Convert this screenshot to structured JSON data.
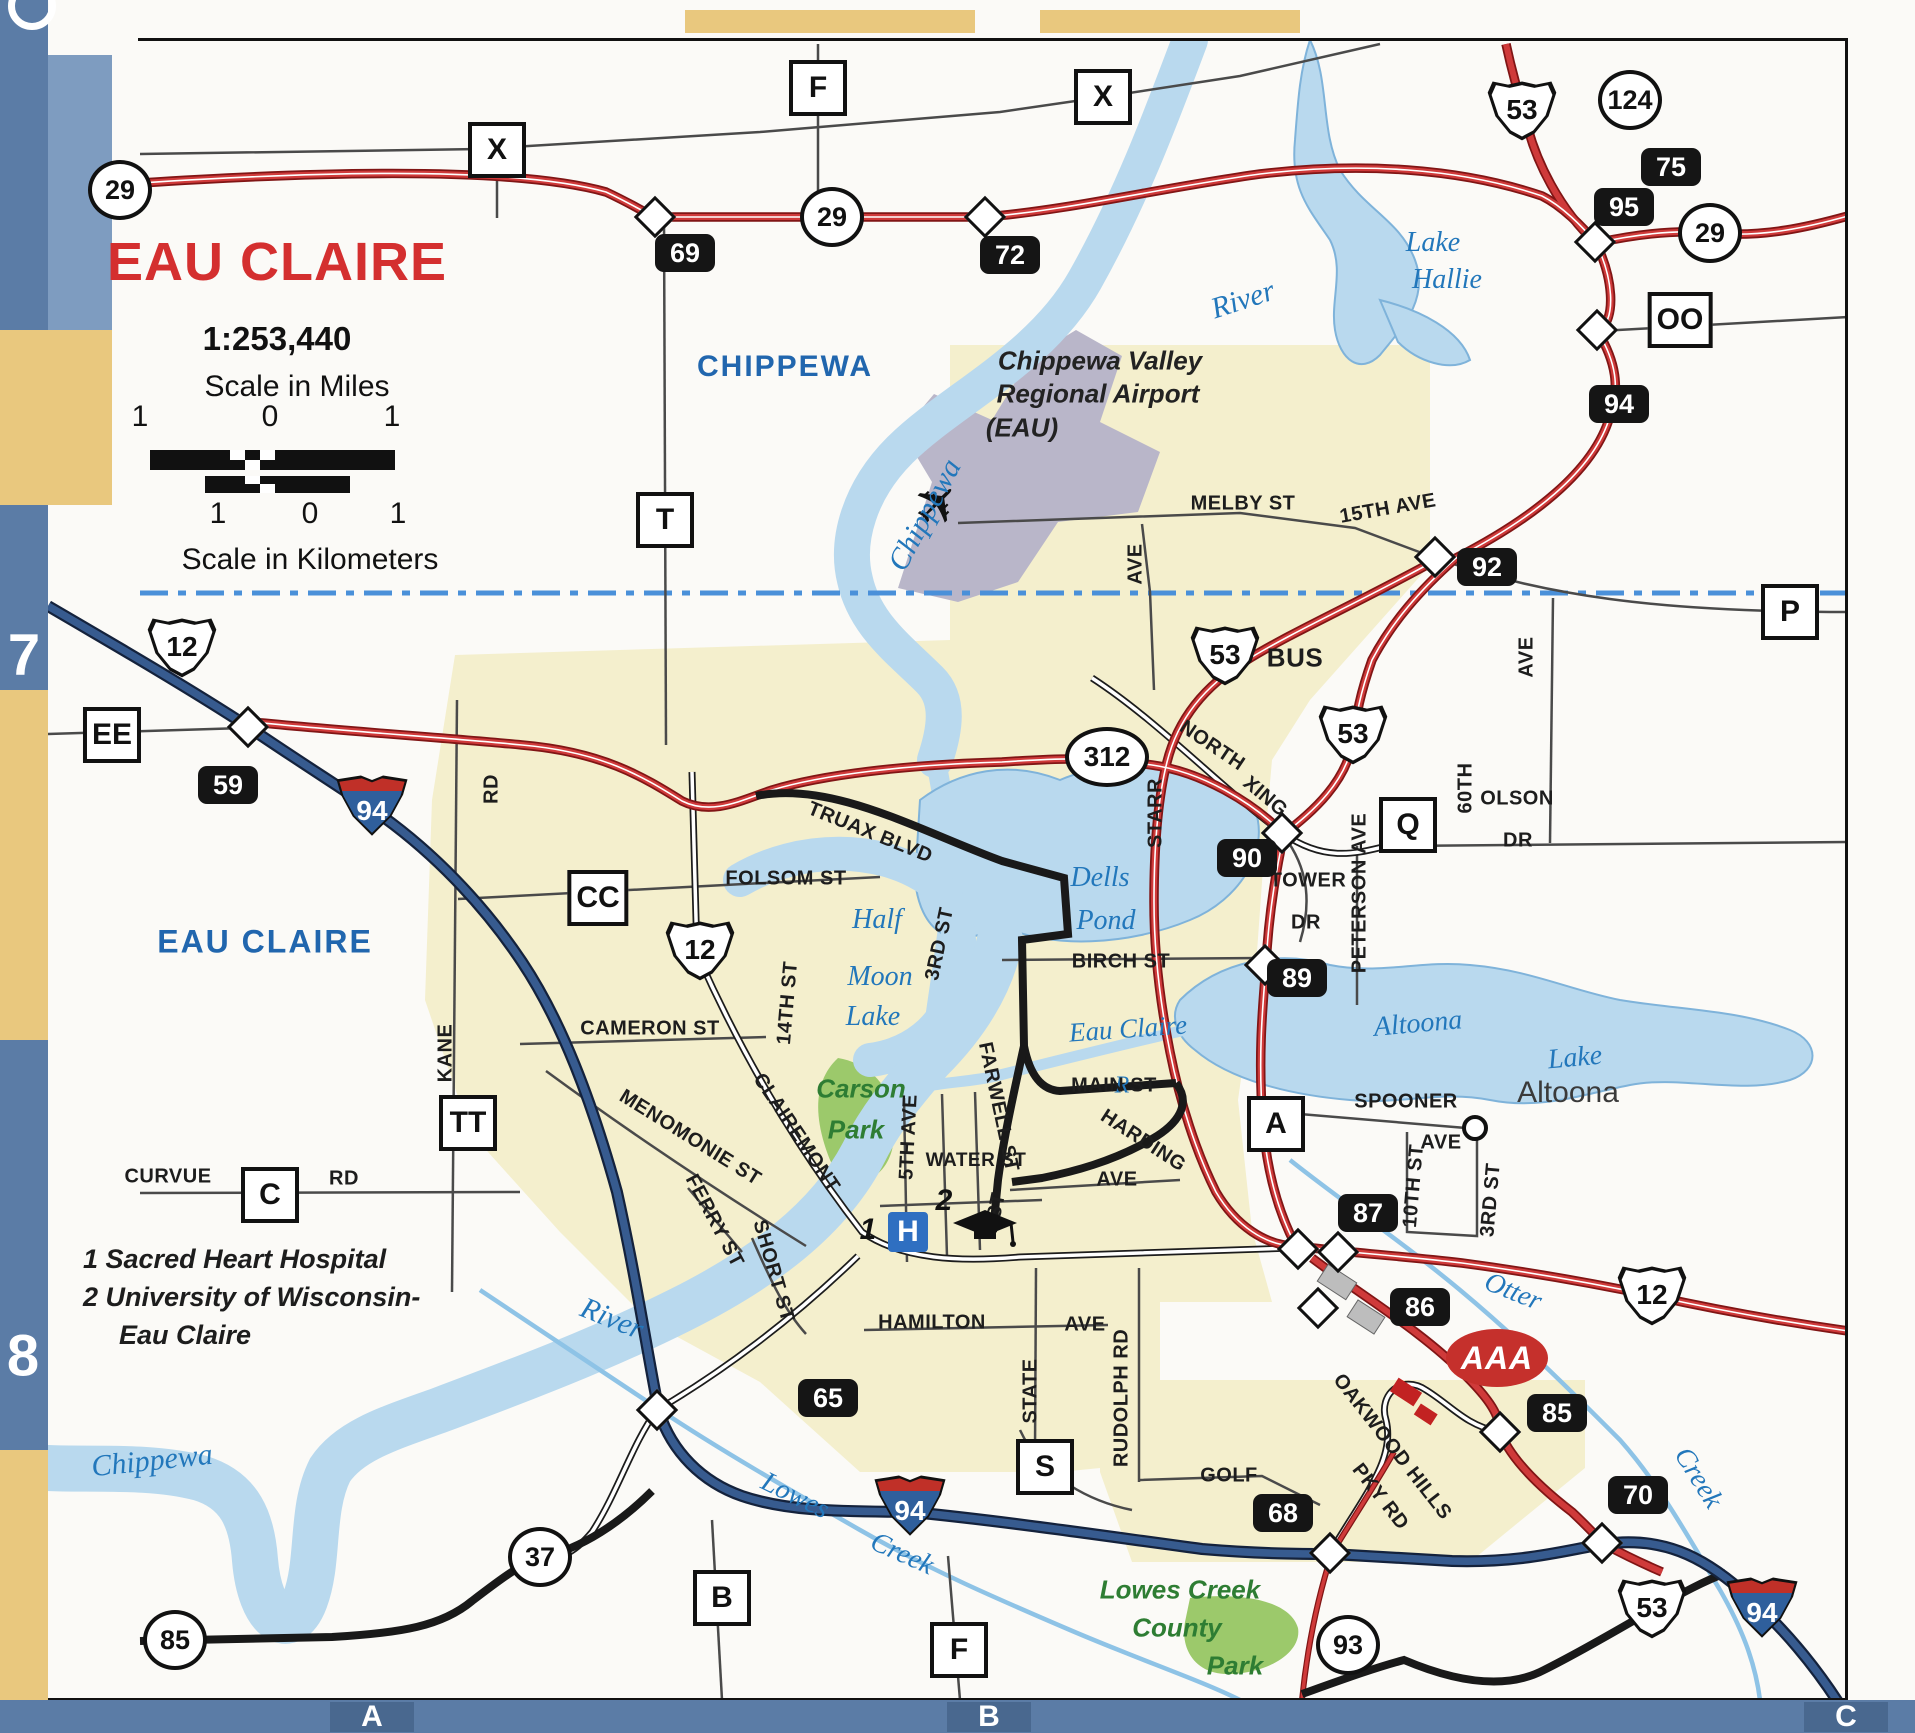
{
  "title": {
    "name": "EAU CLAIRE",
    "ratio": "1:253,440",
    "scale_miles_label": "Scale in Miles",
    "scale_km_label": "Scale in Kilometers",
    "miles_ticks": [
      "1",
      "0",
      "1"
    ],
    "km_ticks": [
      "1",
      "0",
      "1"
    ]
  },
  "legend": {
    "lines": [
      "1 Sacred Heart Hospital",
      "2 University of Wisconsin-",
      "Eau Claire"
    ]
  },
  "grid": {
    "left": [
      "7",
      "8"
    ],
    "bottom": [
      "A",
      "B",
      "C"
    ]
  },
  "colors": {
    "highway_red": "#cf3a3a",
    "interstate_blue": "#375b8f",
    "water_blue": "#b9d9ee",
    "urban_yellow": "#f4efcd",
    "park_green": "#9cc96b",
    "airport_gray": "#b9b6c9",
    "border_blue": "#5b7ca6",
    "border_yellow": "#e9c87e",
    "title_red": "#d42f2f",
    "water_label_blue": "#2277bb",
    "county_label_blue": "#2166ae",
    "park_label_green": "#2e7d33"
  },
  "icons": {
    "hospital_label": "H",
    "aaa_label": "AAA",
    "airplane_glyph": "✈"
  },
  "map": {
    "markers": [
      {
        "kind": "us",
        "label": "53",
        "x": 1522,
        "y": 110
      },
      {
        "kind": "us",
        "label": "53",
        "x": 1225,
        "y": 655
      },
      {
        "kind": "us",
        "label": "53",
        "x": 1353,
        "y": 734
      },
      {
        "kind": "us",
        "label": "12",
        "x": 182,
        "y": 647
      },
      {
        "kind": "us",
        "label": "12",
        "x": 700,
        "y": 950
      },
      {
        "kind": "us",
        "label": "12",
        "x": 1652,
        "y": 1295
      },
      {
        "kind": "us",
        "label": "53",
        "x": 1652,
        "y": 1608
      },
      {
        "kind": "interstate",
        "label": "94",
        "x": 372,
        "y": 805
      },
      {
        "kind": "interstate",
        "label": "94",
        "x": 910,
        "y": 1505
      },
      {
        "kind": "interstate",
        "label": "94",
        "x": 1762,
        "y": 1607
      },
      {
        "kind": "circle",
        "label": "29",
        "x": 120,
        "y": 190
      },
      {
        "kind": "circle",
        "label": "29",
        "x": 832,
        "y": 217
      },
      {
        "kind": "circle",
        "label": "124",
        "x": 1630,
        "y": 100
      },
      {
        "kind": "circle",
        "label": "29",
        "x": 1710,
        "y": 233
      },
      {
        "kind": "circle",
        "label": "37",
        "x": 540,
        "y": 1557
      },
      {
        "kind": "circle",
        "label": "85",
        "x": 175,
        "y": 1640
      },
      {
        "kind": "circle",
        "label": "93",
        "x": 1348,
        "y": 1645
      },
      {
        "kind": "oval",
        "label": "312",
        "x": 1107,
        "y": 757
      },
      {
        "kind": "exit",
        "label": "69",
        "x": 685,
        "y": 253
      },
      {
        "kind": "exit",
        "label": "72",
        "x": 1010,
        "y": 255
      },
      {
        "kind": "exit",
        "label": "75",
        "x": 1671,
        "y": 167
      },
      {
        "kind": "exit",
        "label": "95",
        "x": 1624,
        "y": 207
      },
      {
        "kind": "exit",
        "label": "94",
        "x": 1619,
        "y": 404
      },
      {
        "kind": "exit",
        "label": "92",
        "x": 1487,
        "y": 567
      },
      {
        "kind": "exit",
        "label": "90",
        "x": 1247,
        "y": 858
      },
      {
        "kind": "exit",
        "label": "89",
        "x": 1297,
        "y": 978
      },
      {
        "kind": "exit",
        "label": "87",
        "x": 1368,
        "y": 1213
      },
      {
        "kind": "exit",
        "label": "86",
        "x": 1420,
        "y": 1307
      },
      {
        "kind": "exit",
        "label": "85",
        "x": 1557,
        "y": 1413
      },
      {
        "kind": "exit",
        "label": "70",
        "x": 1638,
        "y": 1495
      },
      {
        "kind": "exit",
        "label": "65",
        "x": 828,
        "y": 1398
      },
      {
        "kind": "exit",
        "label": "68",
        "x": 1283,
        "y": 1513
      },
      {
        "kind": "exit",
        "label": "59",
        "x": 228,
        "y": 785
      },
      {
        "kind": "county",
        "label": "F",
        "x": 818,
        "y": 88
      },
      {
        "kind": "county",
        "label": "X",
        "x": 497,
        "y": 150
      },
      {
        "kind": "county",
        "label": "X",
        "x": 1103,
        "y": 97
      },
      {
        "kind": "county",
        "label": "T",
        "x": 665,
        "y": 520
      },
      {
        "kind": "county",
        "label": "OO",
        "x": 1680,
        "y": 320
      },
      {
        "kind": "county",
        "label": "P",
        "x": 1790,
        "y": 612
      },
      {
        "kind": "county",
        "label": "EE",
        "x": 112,
        "y": 735
      },
      {
        "kind": "county",
        "label": "CC",
        "x": 598,
        "y": 898
      },
      {
        "kind": "county",
        "label": "Q",
        "x": 1408,
        "y": 825
      },
      {
        "kind": "county",
        "label": "TT",
        "x": 468,
        "y": 1123
      },
      {
        "kind": "county",
        "label": "C",
        "x": 270,
        "y": 1195
      },
      {
        "kind": "county",
        "label": "A",
        "x": 1276,
        "y": 1124
      },
      {
        "kind": "county",
        "label": "S",
        "x": 1045,
        "y": 1467
      },
      {
        "kind": "county",
        "label": "B",
        "x": 722,
        "y": 1598
      },
      {
        "kind": "county",
        "label": "F",
        "x": 959,
        "y": 1650
      },
      {
        "kind": "diamond",
        "label": "",
        "x": 655,
        "y": 217
      },
      {
        "kind": "diamond",
        "label": "",
        "x": 985,
        "y": 217
      },
      {
        "kind": "diamond",
        "label": "",
        "x": 1595,
        "y": 242
      },
      {
        "kind": "diamond",
        "label": "",
        "x": 1597,
        "y": 330
      },
      {
        "kind": "diamond",
        "label": "",
        "x": 1435,
        "y": 557
      },
      {
        "kind": "diamond",
        "label": "",
        "x": 248,
        "y": 727
      },
      {
        "kind": "diamond",
        "label": "",
        "x": 1282,
        "y": 833
      },
      {
        "kind": "diamond",
        "label": "",
        "x": 1265,
        "y": 965
      },
      {
        "kind": "diamond",
        "label": "",
        "x": 657,
        "y": 1410
      },
      {
        "kind": "diamond",
        "label": "",
        "x": 1298,
        "y": 1249
      },
      {
        "kind": "diamond",
        "label": "",
        "x": 1338,
        "y": 1252
      },
      {
        "kind": "diamond",
        "label": "",
        "x": 1318,
        "y": 1308
      },
      {
        "kind": "diamond",
        "label": "",
        "x": 1500,
        "y": 1432
      },
      {
        "kind": "diamond",
        "label": "",
        "x": 1602,
        "y": 1543
      },
      {
        "kind": "diamond",
        "label": "",
        "x": 1330,
        "y": 1553
      },
      {
        "kind": "citydot",
        "label": "",
        "x": 1475,
        "y": 1128
      }
    ],
    "labels": [
      {
        "t": "CHIPPEWA",
        "x": 785,
        "y": 367,
        "c": "cty"
      },
      {
        "t": "EAU CLAIRE",
        "x": 265,
        "y": 942,
        "c": "cty",
        "s": 32
      },
      {
        "t": "River",
        "x": 1243,
        "y": 300,
        "c": "wat",
        "s": 30,
        "r": -18
      },
      {
        "t": "Chippewa",
        "x": 925,
        "y": 515,
        "c": "wat",
        "s": 30,
        "r": -62
      },
      {
        "t": "Lake",
        "x": 1433,
        "y": 243,
        "c": "wat"
      },
      {
        "t": "Hallie",
        "x": 1447,
        "y": 280,
        "c": "wat"
      },
      {
        "t": "Dells",
        "x": 1100,
        "y": 878,
        "c": "wat"
      },
      {
        "t": "Pond",
        "x": 1106,
        "y": 921,
        "c": "wat"
      },
      {
        "t": "Half",
        "x": 877,
        "y": 920,
        "c": "wat"
      },
      {
        "t": "Moon",
        "x": 880,
        "y": 977,
        "c": "wat"
      },
      {
        "t": "Lake",
        "x": 873,
        "y": 1017,
        "c": "wat"
      },
      {
        "t": "Eau Claire",
        "x": 1128,
        "y": 1029,
        "c": "wat",
        "s": 27,
        "r": -4
      },
      {
        "t": "R",
        "x": 1122,
        "y": 1086,
        "c": "wat",
        "s": 24
      },
      {
        "t": "Altoona",
        "x": 1418,
        "y": 1024,
        "c": "wat",
        "r": -5
      },
      {
        "t": "Lake",
        "x": 1575,
        "y": 1058,
        "c": "wat",
        "r": -5
      },
      {
        "t": "Otter",
        "x": 1513,
        "y": 1292,
        "c": "wat",
        "r": 22
      },
      {
        "t": "Creek",
        "x": 1698,
        "y": 1478,
        "c": "wat",
        "r": 58
      },
      {
        "t": "Lowes",
        "x": 795,
        "y": 1496,
        "c": "wat",
        "r": 26
      },
      {
        "t": "Creek",
        "x": 902,
        "y": 1554,
        "c": "wat",
        "r": 24
      },
      {
        "t": "Chippewa",
        "x": 152,
        "y": 1461,
        "c": "wat",
        "s": 30,
        "r": -6
      },
      {
        "t": "River",
        "x": 612,
        "y": 1319,
        "c": "wat",
        "s": 30,
        "r": 22
      },
      {
        "t": "Altoona",
        "x": 1568,
        "y": 1093,
        "c": "city"
      },
      {
        "t": "Chippewa Valley",
        "x": 1100,
        "y": 361,
        "c": "air"
      },
      {
        "t": "Regional Airport",
        "x": 1098,
        "y": 394,
        "c": "air"
      },
      {
        "t": "(EAU)",
        "x": 1022,
        "y": 428,
        "c": "air"
      },
      {
        "t": "Carson",
        "x": 861,
        "y": 1089,
        "c": "park"
      },
      {
        "t": "Park",
        "x": 856,
        "y": 1130,
        "c": "park"
      },
      {
        "t": "Lowes Creek",
        "x": 1180,
        "y": 1590,
        "c": "park"
      },
      {
        "t": "County",
        "x": 1177,
        "y": 1628,
        "c": "park"
      },
      {
        "t": "Park",
        "x": 1235,
        "y": 1666,
        "c": "park"
      },
      {
        "t": "1",
        "x": 868,
        "y": 1230,
        "c": "pt"
      },
      {
        "t": "2",
        "x": 944,
        "y": 1201,
        "c": "pt"
      },
      {
        "t": "BUS",
        "x": 1295,
        "y": 658,
        "c": "st",
        "s": 26
      },
      {
        "t": "MELBY ST",
        "x": 1243,
        "y": 504,
        "c": "st"
      },
      {
        "t": "15TH AVE",
        "x": 1388,
        "y": 509,
        "c": "st",
        "r": -10
      },
      {
        "t": "NORTH",
        "x": 1212,
        "y": 746,
        "c": "st",
        "r": 34
      },
      {
        "t": "XING",
        "x": 1265,
        "y": 797,
        "c": "st",
        "r": 40
      },
      {
        "t": "TOWER",
        "x": 1308,
        "y": 881,
        "c": "st"
      },
      {
        "t": "DR",
        "x": 1306,
        "y": 923,
        "c": "st"
      },
      {
        "t": "PETERSON AVE",
        "x": 1360,
        "y": 893,
        "c": "st",
        "r": -90
      },
      {
        "t": "60TH",
        "x": 1466,
        "y": 788,
        "c": "st",
        "r": -90
      },
      {
        "t": "AVE",
        "x": 1527,
        "y": 657,
        "c": "st",
        "r": -90
      },
      {
        "t": "OLSON",
        "x": 1517,
        "y": 799,
        "c": "st"
      },
      {
        "t": "DR",
        "x": 1518,
        "y": 841,
        "c": "st"
      },
      {
        "t": "STARR",
        "x": 1156,
        "y": 813,
        "c": "st",
        "r": -90
      },
      {
        "t": "AVE",
        "x": 1136,
        "y": 564,
        "c": "st",
        "r": -90
      },
      {
        "t": "TRUAX BLVD",
        "x": 870,
        "y": 833,
        "c": "st",
        "r": 22
      },
      {
        "t": "FOLSOM ST",
        "x": 786,
        "y": 879,
        "c": "st"
      },
      {
        "t": "3RD ST",
        "x": 940,
        "y": 944,
        "c": "st",
        "r": -78
      },
      {
        "t": "BIRCH ST",
        "x": 1121,
        "y": 962,
        "c": "st"
      },
      {
        "t": "14TH ST",
        "x": 788,
        "y": 1003,
        "c": "st",
        "r": -85
      },
      {
        "t": "CAMERON ST",
        "x": 650,
        "y": 1029,
        "c": "st"
      },
      {
        "t": "RD",
        "x": 492,
        "y": 789,
        "c": "st",
        "r": -90
      },
      {
        "t": "KANE",
        "x": 446,
        "y": 1053,
        "c": "st",
        "r": -90
      },
      {
        "t": "MENOMONIE ST",
        "x": 690,
        "y": 1138,
        "c": "st",
        "r": 32
      },
      {
        "t": "CLAIREMONT",
        "x": 796,
        "y": 1133,
        "c": "st",
        "r": 56
      },
      {
        "t": "FERRY ST",
        "x": 714,
        "y": 1221,
        "c": "st",
        "r": 62
      },
      {
        "t": "SHORT ST",
        "x": 773,
        "y": 1271,
        "c": "st",
        "r": 74
      },
      {
        "t": "5TH AVE",
        "x": 909,
        "y": 1137,
        "c": "st",
        "r": -87
      },
      {
        "t": "WATER ST",
        "x": 976,
        "y": 1161,
        "c": "st",
        "s": 19
      },
      {
        "t": "ST",
        "x": 997,
        "y": 1206,
        "c": "st",
        "r": -78
      },
      {
        "t": "FARWELL ST",
        "x": 998,
        "y": 1107,
        "c": "st",
        "r": 78
      },
      {
        "t": "MAIN ST",
        "x": 1114,
        "y": 1086,
        "c": "st"
      },
      {
        "t": "HARDING",
        "x": 1143,
        "y": 1141,
        "c": "st",
        "r": 33
      },
      {
        "t": "AVE",
        "x": 1117,
        "y": 1180,
        "c": "st"
      },
      {
        "t": "HAMILTON",
        "x": 932,
        "y": 1323,
        "c": "st"
      },
      {
        "t": "AVE",
        "x": 1085,
        "y": 1325,
        "c": "st"
      },
      {
        "t": "STATE",
        "x": 1031,
        "y": 1391,
        "c": "st",
        "r": -90
      },
      {
        "t": "RUDOLPH RD",
        "x": 1122,
        "y": 1398,
        "c": "st",
        "r": -90
      },
      {
        "t": "GOLF",
        "x": 1229,
        "y": 1476,
        "c": "st"
      },
      {
        "t": "OAKWOOD HILLS",
        "x": 1392,
        "y": 1447,
        "c": "st",
        "r": 52
      },
      {
        "t": "PKY RD",
        "x": 1380,
        "y": 1497,
        "c": "st",
        "r": 52
      },
      {
        "t": "SPOONER",
        "x": 1406,
        "y": 1102,
        "c": "st"
      },
      {
        "t": "AVE",
        "x": 1441,
        "y": 1143,
        "c": "st"
      },
      {
        "t": "10TH ST",
        "x": 1414,
        "y": 1186,
        "c": "st",
        "r": -85
      },
      {
        "t": "3RD ST",
        "x": 1491,
        "y": 1200,
        "c": "st",
        "r": -85
      },
      {
        "t": "CURVUE",
        "x": 168,
        "y": 1177,
        "c": "st"
      },
      {
        "t": "RD",
        "x": 344,
        "y": 1179,
        "c": "st"
      }
    ]
  }
}
